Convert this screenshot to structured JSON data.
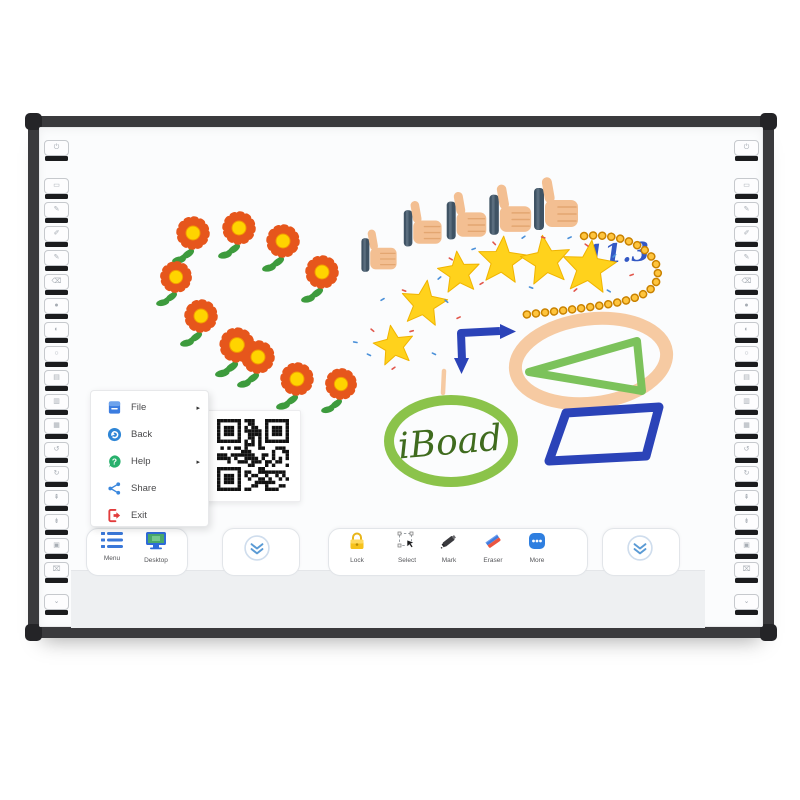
{
  "menu_popup": {
    "items": [
      {
        "label": "File",
        "icon": "file-icon",
        "arrow": "▸"
      },
      {
        "label": "Back",
        "icon": "back-icon",
        "arrow": ""
      },
      {
        "label": "Help",
        "icon": "help-icon",
        "arrow": "▸"
      },
      {
        "label": "Share",
        "icon": "share-icon",
        "arrow": ""
      },
      {
        "label": "Exit",
        "icon": "exit-icon",
        "arrow": ""
      }
    ]
  },
  "toolbar": {
    "left_tab": {
      "items": [
        {
          "label": "Menu",
          "icon": "menu-list-icon"
        },
        {
          "label": "Desktop",
          "icon": "desktop-icon"
        }
      ]
    },
    "center_tab": {
      "items": [
        {
          "label": "Lock",
          "icon": "lock-icon"
        },
        {
          "label": "Select",
          "icon": "select-icon"
        },
        {
          "label": "Mark",
          "icon": "mark-icon"
        },
        {
          "label": "Eraser",
          "icon": "eraser-icon"
        },
        {
          "label": "More",
          "icon": "more-icon"
        }
      ]
    },
    "collapse_left": {
      "icon": "double-chevron-down-icon"
    },
    "collapse_right": {
      "icon": "double-chevron-down-icon"
    }
  },
  "annotations": {
    "score_text": "11.3",
    "ellipse_label": "iBoad"
  },
  "hotkeys": {
    "per_side": 19,
    "glyphs": [
      "⏻",
      "▭",
      "✎",
      "✐",
      "✎",
      "⌫",
      "●",
      "◐",
      "○",
      "▤",
      "▥",
      "▦",
      "↺",
      "↻",
      "⇞",
      "⇟",
      "▣",
      "⌧",
      "⌄"
    ]
  },
  "colors": {
    "frame": "#3a3a3d",
    "accent_blue": "#3a78d9",
    "lock_yellow": "#f6c21c",
    "eraser_red": "#ea5541",
    "eraser_blue": "#3f7ce0",
    "chevron_blue": "#5b9bd5",
    "flower_petal": "#e6561c",
    "flower_center": "#ffd400",
    "leaf_green": "#3d9b3d",
    "star_gold": "#ffd21c",
    "bead_gold": "#ffc53e",
    "score_blue": "#3358c4",
    "shape_blue": "#2b43b8",
    "shape_peach": "#f6caa2",
    "shape_green": "#7cc25b",
    "ellipse_green": "#8bc34a",
    "label_green": "#3f6b1e",
    "skin": "#f3bf92",
    "cuff": "#3f5364"
  },
  "drawings": {
    "flowers": [
      [
        193,
        233,
        1
      ],
      [
        239,
        228,
        1
      ],
      [
        283,
        241,
        1
      ],
      [
        322,
        272,
        1
      ],
      [
        176,
        277,
        0.95
      ],
      [
        201,
        316,
        1
      ],
      [
        237,
        345,
        1.05
      ],
      [
        258,
        357,
        1
      ],
      [
        297,
        379,
        1
      ],
      [
        341,
        384,
        0.95
      ]
    ],
    "thumbs": [
      [
        383,
        251,
        0.8
      ],
      [
        427,
        224,
        0.86
      ],
      [
        471,
        216,
        0.9
      ],
      [
        515,
        210,
        0.95
      ],
      [
        561,
        204,
        1
      ]
    ],
    "stars": [
      [
        394,
        346,
        21,
        -10
      ],
      [
        424,
        304,
        24,
        8
      ],
      [
        459,
        273,
        22,
        -6
      ],
      [
        502,
        261,
        25,
        4
      ],
      [
        546,
        261,
        26,
        -8
      ],
      [
        589,
        268,
        28,
        6
      ]
    ],
    "confetti": [
      [
        371,
        328,
        40,
        0
      ],
      [
        380,
        300,
        -30,
        1
      ],
      [
        402,
        289,
        20,
        0
      ],
      [
        437,
        279,
        -40,
        1
      ],
      [
        449,
        257,
        30,
        0
      ],
      [
        471,
        249,
        -20,
        1
      ],
      [
        493,
        241,
        45,
        0
      ],
      [
        521,
        238,
        -35,
        1
      ],
      [
        541,
        236,
        15,
        0
      ],
      [
        567,
        238,
        -25,
        1
      ],
      [
        585,
        243,
        35,
        0
      ],
      [
        612,
        257,
        -45,
        1
      ],
      [
        367,
        353,
        25,
        1
      ],
      [
        409,
        331,
        -15,
        0
      ],
      [
        445,
        299,
        40,
        1
      ],
      [
        479,
        284,
        -30,
        0
      ],
      [
        529,
        286,
        20,
        1
      ],
      [
        573,
        291,
        -40,
        0
      ],
      [
        607,
        289,
        30,
        1
      ],
      [
        629,
        275,
        -20,
        0
      ],
      [
        353,
        341,
        10,
        1
      ],
      [
        391,
        369,
        -35,
        0
      ],
      [
        432,
        352,
        25,
        1
      ],
      [
        456,
        318,
        -25,
        0
      ]
    ],
    "confetti_colors": [
      "#e2574c",
      "#4a90d9",
      "#f0a93c"
    ],
    "bead_path": "M584 236 C612 233 646 242 656 264 C664 287 645 297 615 303 C583 309 548 312 522 315",
    "arrow": {
      "path": "M500 331 L461 333 L462 360",
      "head_right": "500,324 516,331.5 500,339",
      "head_down": "454,358 469,358 461.5,374"
    },
    "tan_dash": "M444 371 L443 393",
    "peach_ellipse": {
      "cx": 591,
      "cy": 361,
      "rx": 76,
      "ry": 42,
      "rot": -7
    },
    "green_triangle": {
      "points": "529,372 637,341 642,391"
    },
    "green_ellipse": {
      "cx": 451,
      "cy": 441,
      "rx": 62,
      "ry": 41
    },
    "parallelogram": {
      "points": "566,413 659,407 646,456 549,461"
    },
    "score_pos": [
      618,
      262
    ],
    "label_pos": [
      451,
      454
    ]
  }
}
